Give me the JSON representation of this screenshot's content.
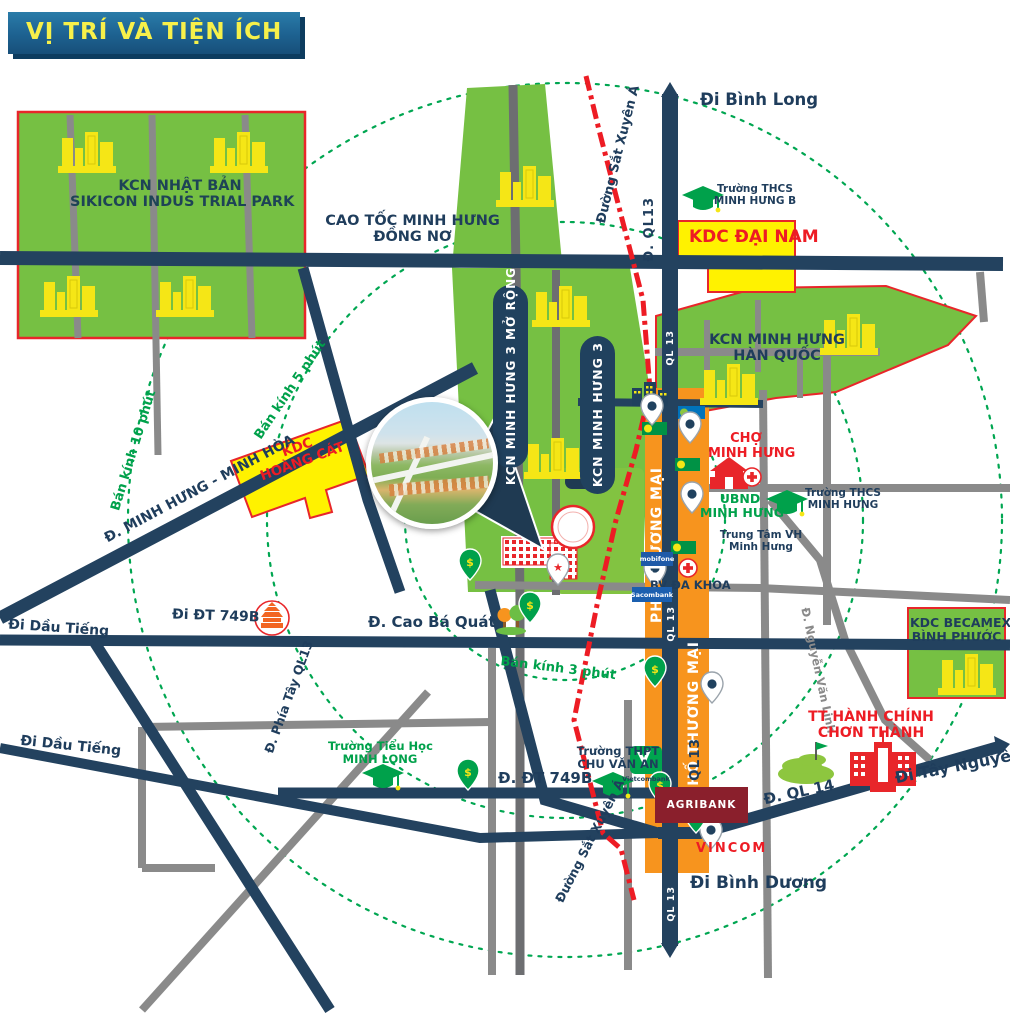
{
  "title": "VỊ TRÍ VÀ TIỆN ÍCH",
  "colors": {
    "navy": "#1F3D5C",
    "zone_green": "#76C043",
    "zone_yellow": "#FFF200",
    "zone_border_red": "#E8262A",
    "orange_strip": "#F7941E",
    "railway_red": "#ED1C24",
    "radius_green": "#00A651",
    "grey_road": "#8A8A8A",
    "banner_blue": "#1d6190",
    "banner_text": "#F7F04A"
  },
  "zones": {
    "kcn_nhat_ban_1": "KCN NHẬT BẢN",
    "kcn_nhat_ban_2": "SIKICON INDUS TRIAL PARK",
    "kdc_dai_nam": "KDC ĐẠI NAM",
    "kcn_han_quoc_1": "KCN MINH HƯNG",
    "kcn_han_quoc_2": "HÀN QUỐC",
    "kcn_mh3_mo_rong": "KCN MINH HƯNG 3 MỞ RỘNG",
    "kcn_mh3": "KCN MINH HƯNG 3",
    "kdc_hoang_cat_1": "KDC",
    "kdc_hoang_cat_2": "HOÀNG CÁT",
    "kdc_becamex_1": "KDC BECAMEX",
    "kdc_becamex_2": "BÌNH PHƯỚC",
    "pho_thuong_mai": "PHỐ THƯƠNG MẠI"
  },
  "roads": {
    "cao_toc_1": "CAO TỐC MINH HƯNG",
    "cao_toc_2": "ĐỒNG NƠ",
    "di_binh_long": "Đi Bình Long",
    "d_ql13": "Đ. QL13",
    "ql13": "QL 13",
    "duong_sat_xuyen_a": "Đường Sắt Xuyên Á",
    "d_minh_hung_minh_hoa": "Đ. MINH HƯNG - MINH HÒA",
    "di_dt_749b": "Đi ĐT 749B",
    "d_dt_749b": "Đ. ĐT 749B",
    "di_dau_tieng": "Đi Dầu Tiếng",
    "d_phia_tay_ql13": "Đ. Phía Tây QL13",
    "d_cao_ba_quat": "Đ. Cao Bá Quát",
    "d_nguyen_van_linh": "Đ. Nguyễn Văn Linh",
    "d_ql14": "Đ. QL 14",
    "di_tay_nguyen": "Đi Tây Nguyên",
    "di_binh_duong": "Đi Bình Dương"
  },
  "radius": {
    "r10": "Bán kính 10 phút",
    "r5": "Bán kính 5 phút",
    "r3": "Bán kính 3 phút"
  },
  "pois": {
    "thcs_minh_hung_b_1": "Trường THCS",
    "thcs_minh_hung_b_2": "MINH HƯNG B",
    "thcs_minh_hung_1": "Trường THCS",
    "thcs_minh_hung_2": "MINH HƯNG",
    "cho_minh_hung_1": "CHỢ",
    "cho_minh_hung_2": "MINH HƯNG",
    "ubnd_minh_hung_1": "UBND",
    "ubnd_minh_hung_2": "MINH HƯNG",
    "trung_tam_vh_1": "Trung Tâm VH",
    "trung_tam_vh_2": "Minh Hưng",
    "bv_da_khoa": "BV ĐA KHOA",
    "tieu_hoc_minh_long_1": "Trường Tiểu Học",
    "tieu_hoc_minh_long_2": "MINH LONG",
    "thpt_chu_van_an_1": "Trường THPT",
    "thpt_chu_van_an_2": "CHU VĂN AN",
    "tt_hanh_chinh_1": "TT HÀNH CHÍNH",
    "tt_hanh_chinh_2": "CHƠN THÀNH",
    "sacombank": "Sacombank",
    "mobifone": "mobifone",
    "vietcombank": "Vietcombank",
    "agribank": "AGRIBANK",
    "vincom": "VINCOM"
  }
}
